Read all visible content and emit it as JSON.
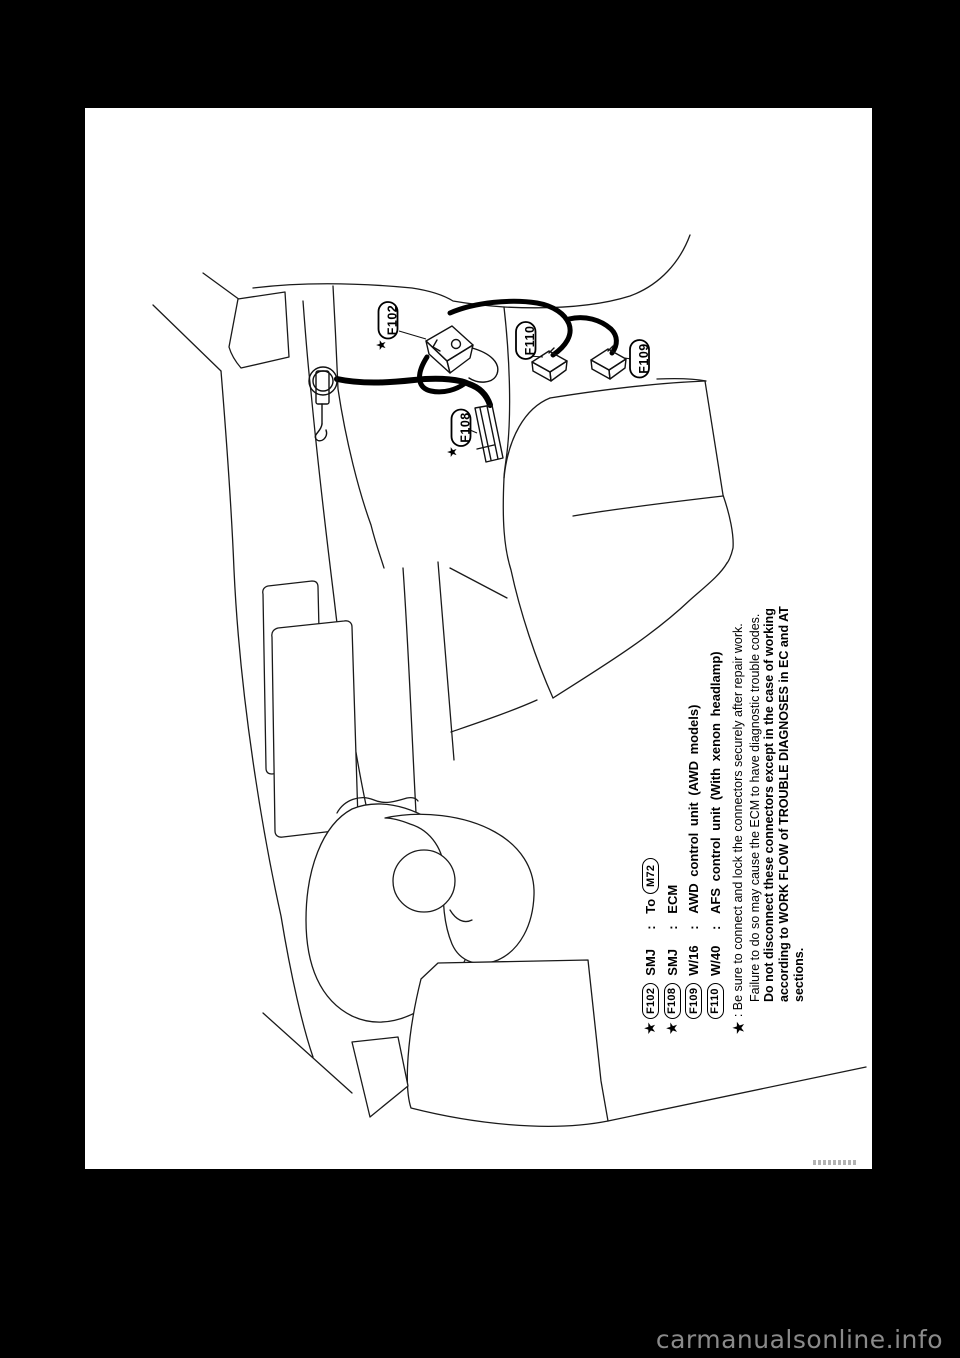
{
  "watermark": "carmanualsonline.info",
  "diagram": {
    "connector_labels": {
      "f102": "F102",
      "f108": "F108",
      "f109": "F109",
      "f110": "F110"
    },
    "star_glyph": "★"
  },
  "legend": {
    "rows": [
      {
        "star": "★",
        "id": "F102",
        "code": "SMJ",
        "sep": ":",
        "desc": "To",
        "ref": "M72"
      },
      {
        "star": "★",
        "id": "F108",
        "code": "SMJ",
        "sep": ":",
        "desc": "ECM",
        "ref": ""
      },
      {
        "star": "",
        "id": "F109",
        "code": "W/16",
        "sep": ":",
        "desc": "AWD control unit (AWD models)",
        "ref": ""
      },
      {
        "star": "",
        "id": "F110",
        "code": "W/40",
        "sep": ":",
        "desc": "AFS control unit (With xenon headlamp)",
        "ref": ""
      }
    ],
    "note": {
      "star": "★",
      "sep": ":",
      "lines": [
        {
          "text": "Be sure to connect and lock the connectors securely after repair work.",
          "bold": false
        },
        {
          "text": "Failure to do so may cause the ECM to have diagnostic trouble codes.",
          "bold": false
        },
        {
          "text": "Do not disconnect these connectors except in the case of working",
          "bold": true
        },
        {
          "text": "according to WORK FLOW of TROUBLE DIAGNOSES in EC and AT",
          "bold": true
        },
        {
          "text": "sections.",
          "bold": true
        }
      ]
    }
  }
}
